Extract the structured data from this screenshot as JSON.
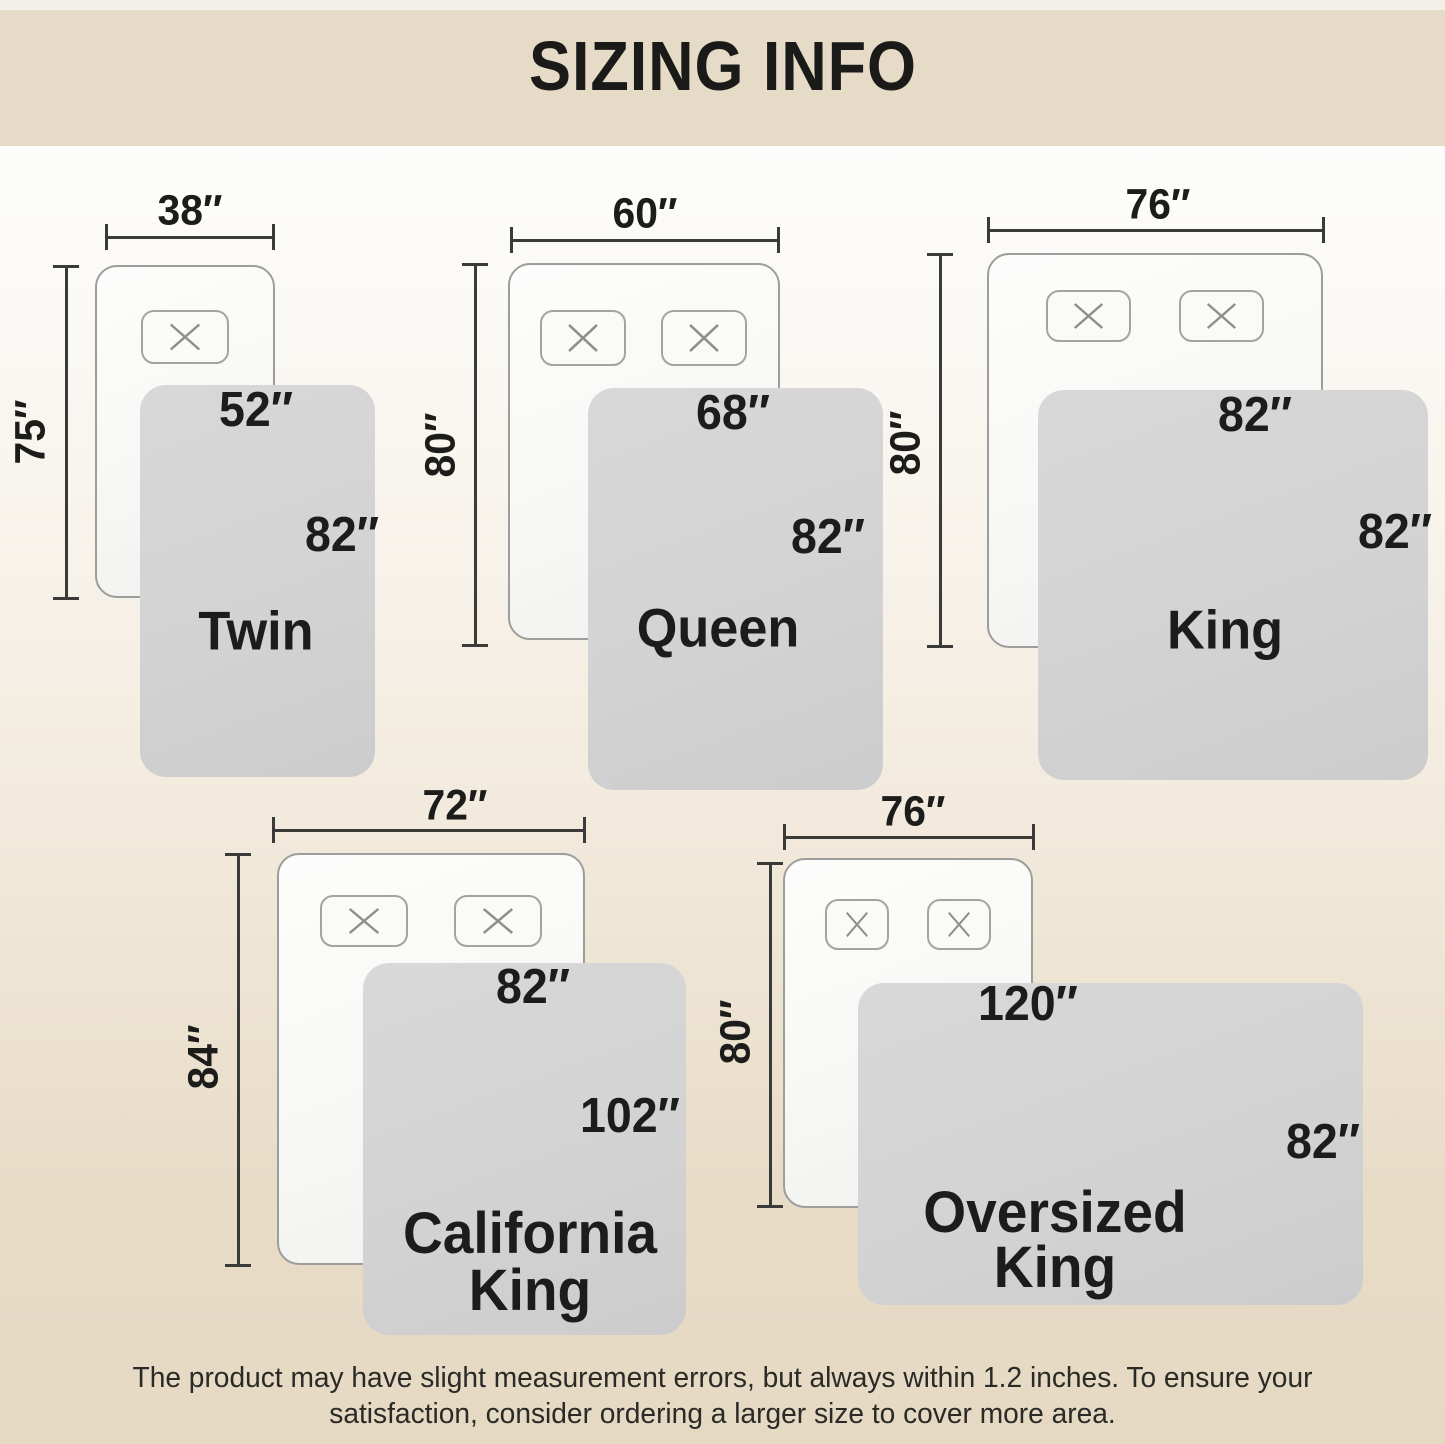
{
  "header": {
    "title": "SIZING INFO"
  },
  "diagrams": [
    {
      "id": "twin",
      "name": "Twin",
      "pillows": 1,
      "bed": {
        "width": "38″",
        "length": "75″"
      },
      "blanket": {
        "width": "52″",
        "length": "82″"
      }
    },
    {
      "id": "queen",
      "name": "Queen",
      "pillows": 2,
      "bed": {
        "width": "60″",
        "length": "80″"
      },
      "blanket": {
        "width": "68″",
        "length": "82″"
      }
    },
    {
      "id": "king",
      "name": "King",
      "pillows": 2,
      "bed": {
        "width": "76″",
        "length": "80″"
      },
      "blanket": {
        "width": "82″",
        "length": "82″"
      }
    },
    {
      "id": "california-king",
      "name": "California King",
      "pillows": 2,
      "bed": {
        "width": "72″",
        "length": "84″"
      },
      "blanket": {
        "width": "82″",
        "length": "102″"
      }
    },
    {
      "id": "oversized-king",
      "name": "Oversized King",
      "pillows": 2,
      "bed": {
        "width": "76″",
        "length": "80″"
      },
      "blanket": {
        "width": "120″",
        "length": "82″"
      }
    }
  ],
  "footer": {
    "lines": [
      "The product may have slight measurement errors, but always within 1.2 inches. To ensure your",
      "satisfaction, consider ordering a larger size to cover more area."
    ]
  }
}
